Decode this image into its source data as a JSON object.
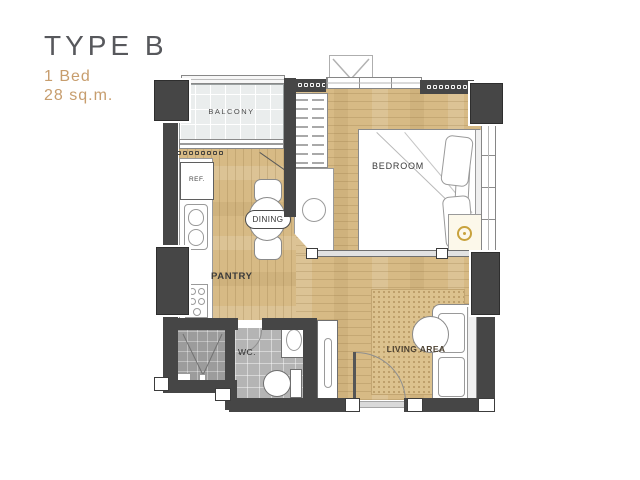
{
  "header": {
    "type_label": "TYPE B",
    "bed_label": "1 Bed",
    "area_label": "28 sq.m."
  },
  "rooms": {
    "balcony": "BALCONY",
    "bedroom": "BEDROOM",
    "dining": "DINING",
    "pantry": "PANTRY",
    "wc": "WC.",
    "living_area": "LIVING AREA",
    "refrigerator": "REF."
  },
  "colors": {
    "wall": "#464646",
    "wood": "#d7ba85",
    "balcony_tile": "#eaeded",
    "wc_tile": "#b4b4b4",
    "shower_tile": "#9c9c9c",
    "rug": "#dcc28e",
    "accent": "#c79d6d",
    "title": "#57585c",
    "gold": "#c8a23c"
  }
}
